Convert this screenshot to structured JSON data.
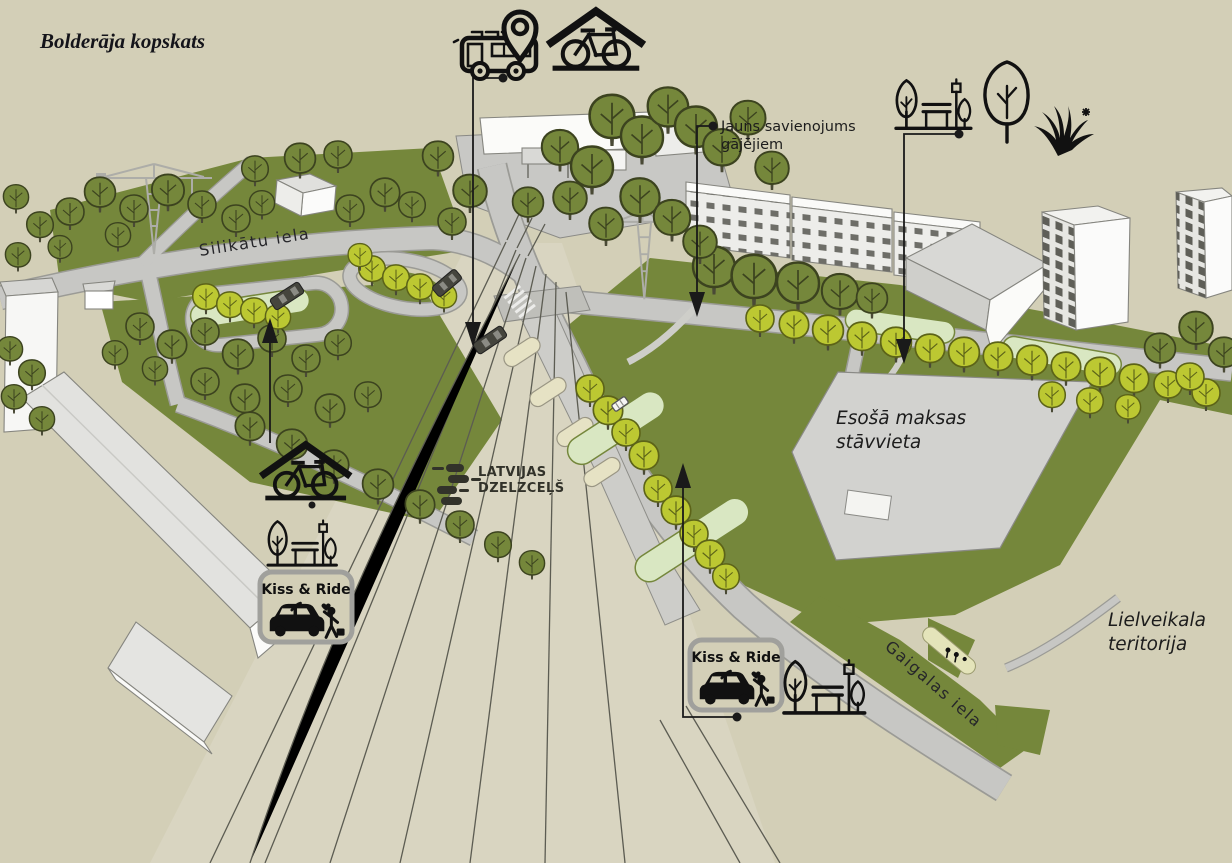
{
  "title": "Bolderāja kopskats",
  "streets": {
    "silikatu": "Silikātu iela",
    "gaigalas": "Gaigalas iela"
  },
  "annotations": {
    "new_connection": {
      "line1": "Jauns savienojums",
      "line2": "gājējiem"
    },
    "existing_parking": {
      "line1": "Esošā maksas",
      "line2": "stāvvieta"
    },
    "mall_area": {
      "line1": "Lielveikala",
      "line2": "teritorija"
    }
  },
  "logo": {
    "line1": "LATVIJAS",
    "line2": "DZELZCEĻŠ"
  },
  "badge": {
    "kiss_and_ride": "Kiss & Ride"
  },
  "icons": {
    "bus_stop": "bus-with-location-pin-icon",
    "bike_shelter": "bicycle-shelter-icon",
    "park": "trees-and-bench-icon",
    "tree": "tree-icon",
    "grass": "grass-icon"
  },
  "colors": {
    "background": "#d3cfb7",
    "lawn": "#76883c",
    "road": "#c7c7c4",
    "tree_yellow": "#bcc832",
    "ink": "#1a1a1a"
  }
}
